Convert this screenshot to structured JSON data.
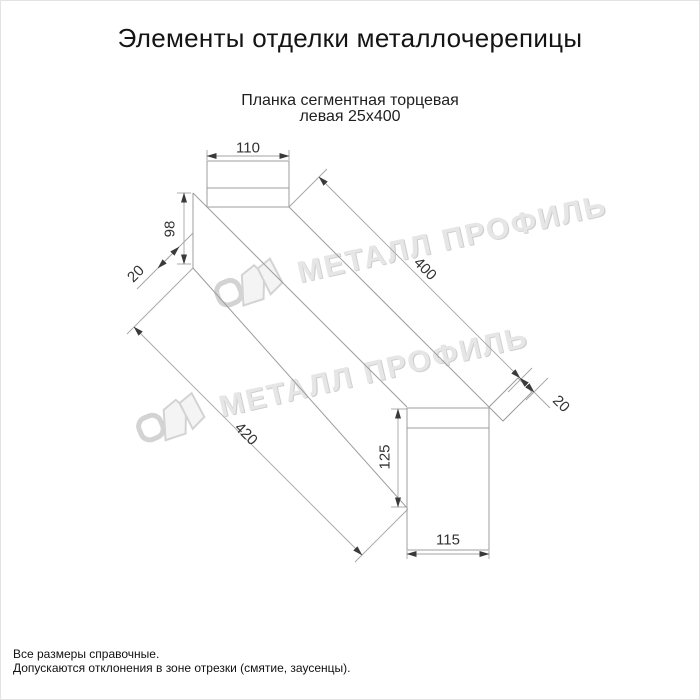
{
  "page": {
    "title": "Элементы отделки металлочерепицы"
  },
  "drawing": {
    "subtitle_line1": "Планка сегментная торцевая",
    "subtitle_line2": "левая 25х400"
  },
  "dimensions": {
    "top_width": "110",
    "left_height": "98",
    "near_fold": "20",
    "top_length": "400",
    "far_fold": "20",
    "bottom_length": "420",
    "right_height": "125",
    "bottom_width": "115"
  },
  "watermark": {
    "text": "МЕТАЛЛ ПРОФИЛЬ",
    "logo": "metall-profil-logo"
  },
  "footer": {
    "line1": "Все размеры справочные.",
    "line2": "Допускаются отклонения в зоне отрезки (смятие, заусенцы)."
  },
  "colors": {
    "outline": "#9c9c9c",
    "dimension_line": "#a3a3a3",
    "arrow": "#3a3a3a",
    "dim_text": "#333333",
    "watermark_gray": "#e2e2e2"
  }
}
